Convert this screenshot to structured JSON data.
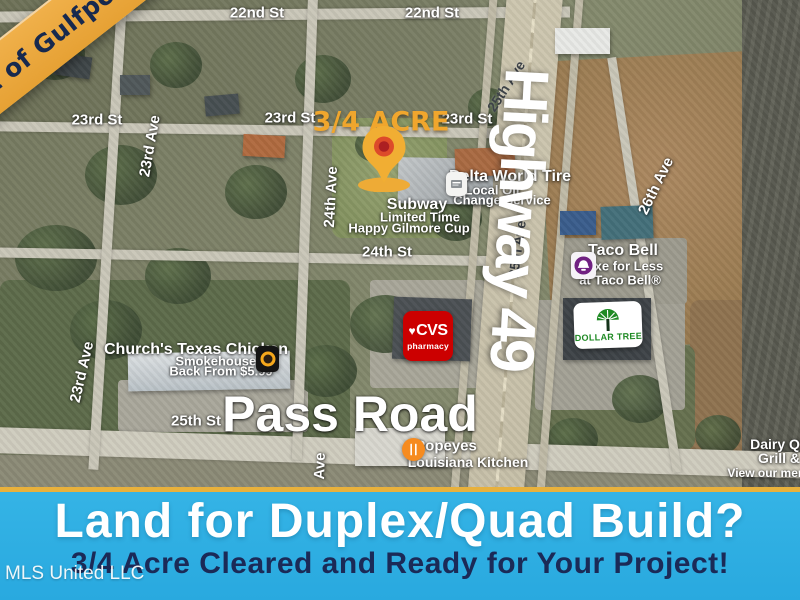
{
  "corner_banner": {
    "text": "Heart of Gulfport"
  },
  "highway_label": {
    "text": "Highway 49"
  },
  "map_labels": [
    {
      "t": "22nd St",
      "x": 85,
      "y": 14,
      "s": 15,
      "n": "street-label"
    },
    {
      "t": "22nd St",
      "x": 257,
      "y": 13,
      "s": 15,
      "n": "street-label"
    },
    {
      "t": "22nd St",
      "x": 432,
      "y": 13,
      "s": 15,
      "n": "street-label"
    },
    {
      "t": "23rd St",
      "x": 97,
      "y": 120,
      "s": 15,
      "n": "street-label"
    },
    {
      "t": "23rd St",
      "x": 290,
      "y": 118,
      "s": 15,
      "n": "street-label"
    },
    {
      "t": "23rd St",
      "x": 467,
      "y": 119,
      "s": 15,
      "n": "street-label"
    },
    {
      "t": "24th St",
      "x": 387,
      "y": 252,
      "s": 15,
      "n": "street-label"
    },
    {
      "t": "25th St",
      "x": 196,
      "y": 421,
      "s": 15,
      "n": "street-label"
    },
    {
      "t": "23rd Ave",
      "x": 150,
      "y": 146,
      "s": 15,
      "r": -80,
      "n": "street-label"
    },
    {
      "t": "24th Ave",
      "x": 331,
      "y": 197,
      "s": 15,
      "r": -87,
      "n": "street-label"
    },
    {
      "t": "23rd Ave",
      "x": 82,
      "y": 372,
      "s": 15,
      "r": -77,
      "n": "street-label"
    },
    {
      "t": "26th Ave",
      "x": 656,
      "y": 186,
      "s": 15,
      "r": -64,
      "n": "street-label"
    },
    {
      "t": "Ave",
      "x": 320,
      "y": 466,
      "s": 15,
      "r": -88,
      "n": "street-label"
    },
    {
      "t": "25th Ave",
      "x": 506,
      "y": 86,
      "s": 14,
      "r": -57,
      "c": "d",
      "n": "street-label"
    },
    {
      "t": "25th Ave",
      "x": 517,
      "y": 249,
      "s": 14,
      "r": -82,
      "c": "d",
      "n": "street-label"
    },
    {
      "t": "Delta World Tire",
      "x": 510,
      "y": 177,
      "s": 16,
      "n": "business-label"
    },
    {
      "t": "Local Oil",
      "x": 492,
      "y": 190,
      "s": 13,
      "n": "business-label"
    },
    {
      "t": "Change Service",
      "x": 502,
      "y": 200,
      "s": 13,
      "n": "business-label"
    },
    {
      "t": "Subway",
      "x": 417,
      "y": 205,
      "s": 16,
      "n": "business-label"
    },
    {
      "t": "Limited Time",
      "x": 420,
      "y": 217,
      "s": 13,
      "n": "business-label"
    },
    {
      "t": "Happy Gilmore Cup",
      "x": 409,
      "y": 228,
      "s": 13,
      "n": "business-label"
    },
    {
      "t": "Taco Bell",
      "x": 623,
      "y": 251,
      "s": 16,
      "n": "business-label"
    },
    {
      "t": "Luxe for Less",
      "x": 621,
      "y": 266,
      "s": 13,
      "n": "business-label"
    },
    {
      "t": "at Taco Bell®",
      "x": 620,
      "y": 280,
      "s": 13,
      "n": "business-label"
    },
    {
      "t": "Church's Texas Chicken",
      "x": 196,
      "y": 350,
      "s": 16,
      "n": "business-label"
    },
    {
      "t": "Smokehouse Is",
      "x": 223,
      "y": 361,
      "s": 13,
      "n": "business-label"
    },
    {
      "t": "Back From $5.99",
      "x": 221,
      "y": 371,
      "s": 13,
      "n": "business-label"
    },
    {
      "t": "Popeyes",
      "x": 446,
      "y": 446,
      "s": 15,
      "n": "business-label"
    },
    {
      "t": "Louisiana Kitchen",
      "x": 468,
      "y": 462,
      "s": 14,
      "n": "business-label"
    },
    {
      "t": "Dairy Q",
      "x": 775,
      "y": 444,
      "s": 14,
      "n": "business-label"
    },
    {
      "t": "Grill &",
      "x": 779,
      "y": 458,
      "s": 14,
      "n": "business-label"
    },
    {
      "t": "View our menu",
      "x": 770,
      "y": 473,
      "s": 12,
      "n": "business-label"
    },
    {
      "t": "3/4 ACRE",
      "x": 381,
      "y": 122,
      "s": 27,
      "c": "g",
      "n": "acre-callout"
    },
    {
      "t": "Pass Road",
      "x": 350,
      "y": 414,
      "s": 50,
      "n": "road-name-label"
    }
  ],
  "logos": {
    "cvs": {
      "heart": "♥",
      "name": "CVS",
      "sub": "pharmacy"
    },
    "dollar_tree": {
      "name": "DOLLAR TREE"
    }
  },
  "icons": {
    "pin": "location-pin",
    "taco_bell": "taco-bell-logo",
    "churchs": "churchs-chicken-logo",
    "popeyes": "popeyes-logo",
    "delta": "delta-world-tire-logo"
  },
  "bottom_banner": {
    "title": "Land for Duplex/Quad Build?",
    "subtitle": "3/4 Acre Cleared and Ready for Your Project!"
  },
  "watermark": "MLS United LLC",
  "colors": {
    "gold": "#E8B13C",
    "banner_blue": "#2FB0E4",
    "navy": "#1B2A57",
    "corner_text_navy": "#17294E",
    "cvs_red": "#CC0000",
    "dollar_tree_green": "#1F8A24",
    "taco_bell_purple": "#702082",
    "popeyes_orange": "#F68B1F",
    "acre_gold": "#F0A62D"
  }
}
